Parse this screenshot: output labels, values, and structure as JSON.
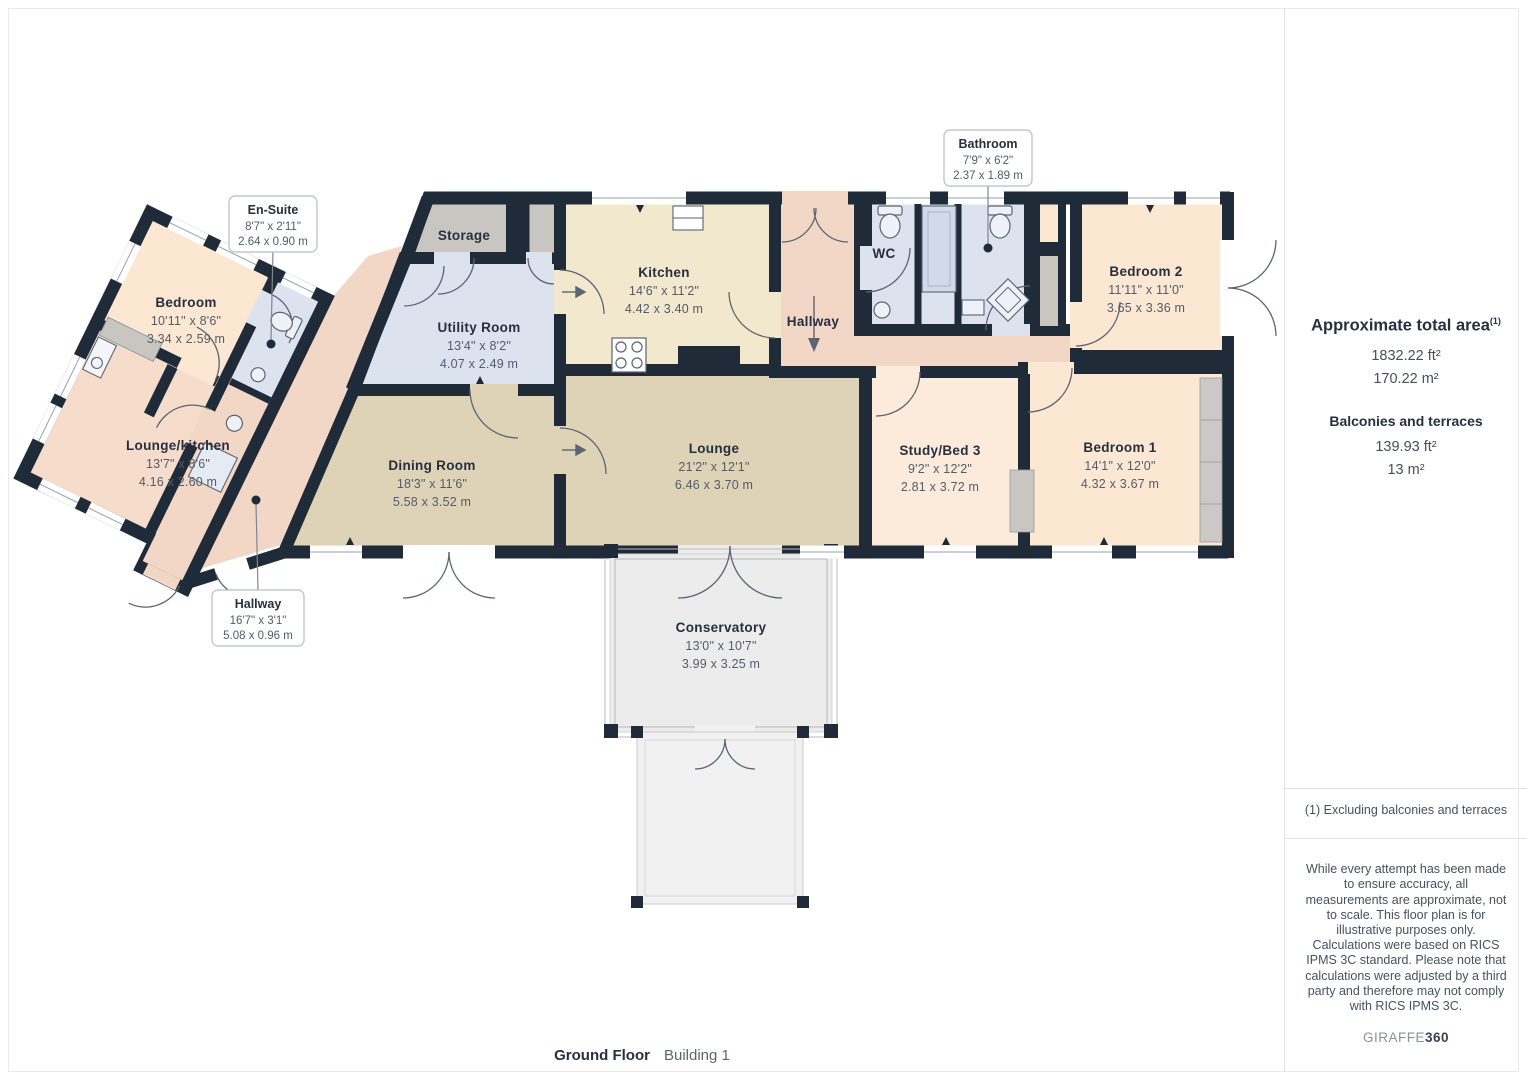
{
  "palette": {
    "wall": "#202b3a",
    "peach": "#fbe7d2",
    "salmon": "#f2d7c6",
    "wing_lounge": "#f6dcca",
    "tan": "#ded3b6",
    "cream": "#f2e8cd",
    "blue": "#dde2ef",
    "gray": "#c9c6c2",
    "conservatory": "#ececec",
    "terrace": "#f1f1f1"
  },
  "plan": {
    "rooms": [
      {
        "name": "Bedroom",
        "dims_ft": "10'11\" x 8'6\"",
        "dims_m": "3.34 x 2.59 m"
      },
      {
        "name": "Lounge/kitchen",
        "dims_ft": "13'7\" x 8'6\"",
        "dims_m": "4.16 x 2.60 m"
      },
      {
        "name": "Storage",
        "dims_ft": "",
        "dims_m": ""
      },
      {
        "name": "Utility Room",
        "dims_ft": "13'4\" x 8'2\"",
        "dims_m": "4.07 x 2.49 m"
      },
      {
        "name": "Kitchen",
        "dims_ft": "14'6\" x 11'2\"",
        "dims_m": "4.42 x 3.40 m"
      },
      {
        "name": "Hallway",
        "dims_ft": "",
        "dims_m": ""
      },
      {
        "name": "WC",
        "dims_ft": "",
        "dims_m": ""
      },
      {
        "name": "Bedroom 2",
        "dims_ft": "11'11\" x 11'0\"",
        "dims_m": "3.65 x 3.36 m"
      },
      {
        "name": "Dining Room",
        "dims_ft": "18'3\" x 11'6\"",
        "dims_m": "5.58 x 3.52 m"
      },
      {
        "name": "Lounge",
        "dims_ft": "21'2\" x 12'1\"",
        "dims_m": "6.46 x 3.70 m"
      },
      {
        "name": "Study/Bed 3",
        "dims_ft": "9'2\" x 12'2\"",
        "dims_m": "2.81 x 3.72 m"
      },
      {
        "name": "Bedroom 1",
        "dims_ft": "14'1\" x 12'0\"",
        "dims_m": "4.32 x 3.67 m"
      },
      {
        "name": "Conservatory",
        "dims_ft": "13'0\" x 10'7\"",
        "dims_m": "3.99 x 3.25 m"
      }
    ],
    "callouts": [
      {
        "title": "En-Suite",
        "dims_ft": "8'7\" x 2'11\"",
        "dims_m": "2.64 x 0.90 m"
      },
      {
        "title": "Bathroom",
        "dims_ft": "7'9\" x 6'2\"",
        "dims_m": "2.37 x 1.89 m"
      },
      {
        "title": "Hallway",
        "dims_ft": "16'7\" x 3'1\"",
        "dims_m": "5.08 x 0.96 m"
      }
    ]
  },
  "sidebar": {
    "total_title": "Approximate total area",
    "total_sup": "(1)",
    "total_ft": "1832.22 ft²",
    "total_m": "170.22 m²",
    "balconies_title": "Balconies and terraces",
    "balconies_ft": "139.93 ft²",
    "balconies_m": "13 m²",
    "note": "(1) Excluding balconies and terraces",
    "disclaimer_1": "While every attempt has been made to ensure accuracy, all measurements are approximate, not to scale. This floor plan is for illustrative purposes only.",
    "disclaimer_2": "Calculations were based on RICS IPMS 3C standard. Please note that calculations were adjusted by a third party and therefore may not comply with RICS IPMS 3C.",
    "brand": "GIRAFFE",
    "brand_suffix": "360"
  },
  "footer": {
    "floor": "Ground Floor",
    "building": "Building 1"
  }
}
